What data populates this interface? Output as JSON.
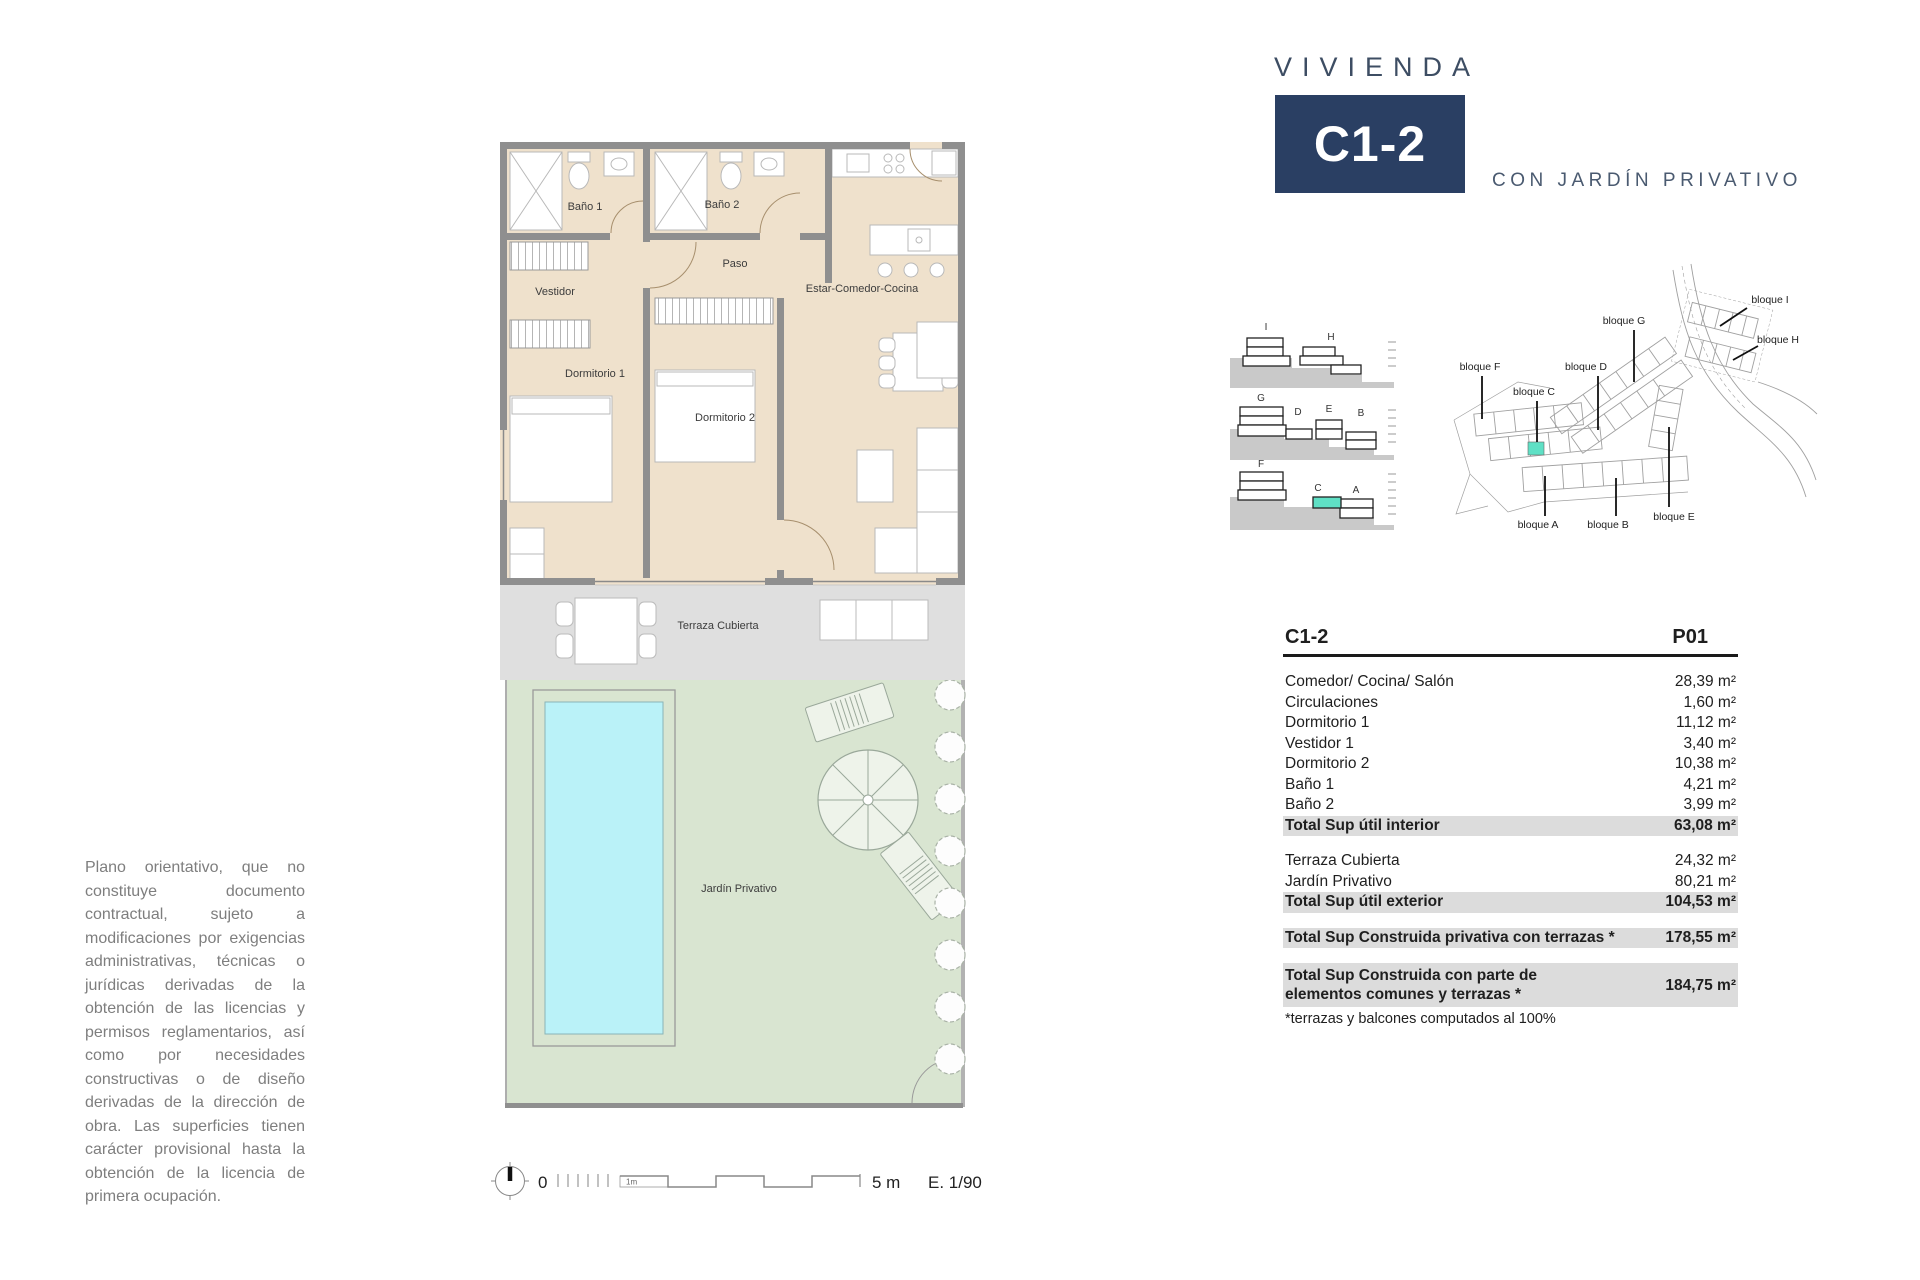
{
  "colors": {
    "navy": "#2a3f63",
    "room_fill": "#efe1cc",
    "wall": "#8f8f8f",
    "terrace_fill": "#dfdfdf",
    "garden_fill": "#d9e5d1",
    "pool_fill": "#baf2f8",
    "highlight_teal": "#5fe0c5",
    "table_highlight": "#dcdcdc"
  },
  "header": {
    "brand": "VIVIENDA",
    "unit": "C1-2",
    "subtitle": "CON JARDÍN PRIVATIVO"
  },
  "plan": {
    "rooms": {
      "bano1": "Baño 1",
      "bano2": "Baño 2",
      "paso": "Paso",
      "vestidor": "Vestidor",
      "dormitorio1": "Dormitorio 1",
      "dormitorio2": "Dormitorio 2",
      "estar": "Estar-Comedor-Cocina",
      "terraza": "Terraza Cubierta",
      "jardin": "Jardín Privativo"
    }
  },
  "scalebar": {
    "zero": "0",
    "first_meter": "1m",
    "end": "5 m",
    "scale": "E. 1/90"
  },
  "elevations": {
    "row1": [
      "I",
      "H"
    ],
    "row2": [
      "G",
      "D",
      "E",
      "B"
    ],
    "row3": [
      "F",
      "C",
      "A"
    ]
  },
  "siteplan": {
    "bloque_i": "bloque I",
    "bloque_h": "bloque H",
    "bloque_g": "bloque G",
    "bloque_d": "bloque D",
    "bloque_f": "bloque F",
    "bloque_c": "bloque C",
    "bloque_a": "bloque A",
    "bloque_b": "bloque B",
    "bloque_e": "bloque E"
  },
  "table": {
    "unit": "C1-2",
    "floor": "P01",
    "interior_rows": [
      {
        "label": "Comedor/ Cocina/ Salón",
        "value": "28,39 m²"
      },
      {
        "label": "Circulaciones",
        "value": "1,60 m²"
      },
      {
        "label": "Dormitorio 1",
        "value": "11,12 m²"
      },
      {
        "label": "Vestidor 1",
        "value": "3,40 m²"
      },
      {
        "label": "Dormitorio 2",
        "value": "10,38 m²"
      },
      {
        "label": "Baño 1",
        "value": "4,21 m²"
      },
      {
        "label": "Baño 2",
        "value": "3,99 m²"
      }
    ],
    "interior_total": {
      "label": "Total Sup útil interior",
      "value": "63,08 m²"
    },
    "exterior_rows": [
      {
        "label": "Terraza Cubierta",
        "value": "24,32 m²"
      },
      {
        "label": "Jardín Privativo",
        "value": "80,21 m²"
      }
    ],
    "exterior_total": {
      "label": "Total Sup útil exterior",
      "value": "104,53 m²"
    },
    "built_private": {
      "label": "Total Sup Construida privativa con terrazas *",
      "value": "178,55 m²"
    },
    "built_common": {
      "label": "Total Sup Construida con parte de elementos comunes y terrazas *",
      "value": "184,75 m²"
    },
    "footnote": "*terrazas y balcones computados al 100%"
  },
  "disclaimer": "Plano orientativo, que no constituye documento contractual, sujeto a modificaciones por exigencias administrativas, técnicas o jurídicas derivadas de la obtención de las licencias y permisos reglamentarios, así como por necesidades constructivas o de diseño derivadas de la dirección de obra. Las superficies tienen carácter provisional hasta la obtención de la licencia de primera ocupación."
}
